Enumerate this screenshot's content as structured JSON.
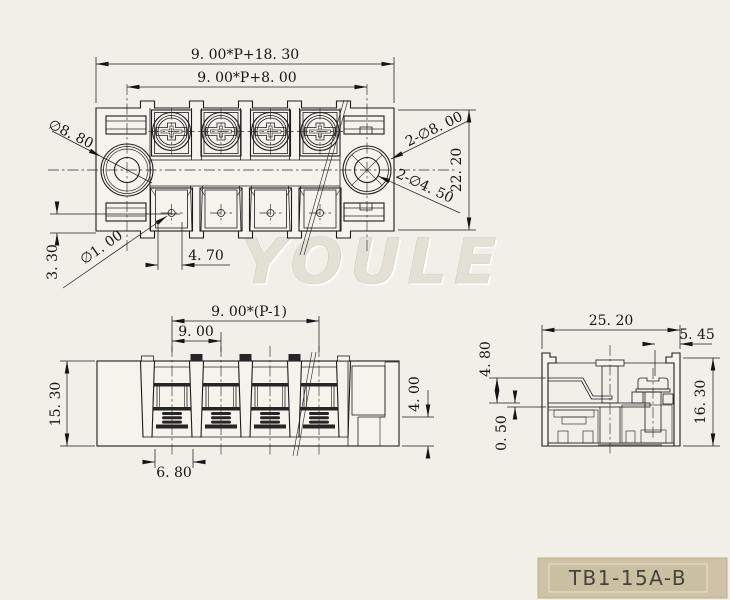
{
  "drawing": {
    "watermark": "YOULE",
    "title_block": {
      "part_number": "TB1-15A-B"
    },
    "colors": {
      "background": "#f2efe9",
      "line": "#1c1c1c",
      "title_bg": "#cfc2a6",
      "title_inner": "#cbbfa2",
      "title_text": "#47433a",
      "watermark": "#e4e0d5"
    },
    "top_view": {
      "dim_overall_width": "9. 00*P+18. 30",
      "dim_mount_spacing": "9. 00*P+8. 00",
      "dim_depth": "22. 20",
      "label_mount_hole": "∅8. 80",
      "label_wire_hole": "∅1. 00",
      "label_holes_large": "2-∅8. 00",
      "label_holes_small": "2-∅4. 50",
      "dim_hole_offset": "3. 30",
      "dim_hole_pitch": "4. 70"
    },
    "front_view": {
      "dim_total_pitch": "9. 00*(P-1)",
      "dim_pitch": "9. 00",
      "dim_height": "15. 30",
      "dim_notch": "4. 00",
      "dim_slot": "6. 80"
    },
    "section_view": {
      "dim_width": "25. 20",
      "dim_top": "5. 45",
      "dim_contact": "4. 80",
      "dim_base": "0. 50",
      "dim_height": "16. 30"
    }
  }
}
